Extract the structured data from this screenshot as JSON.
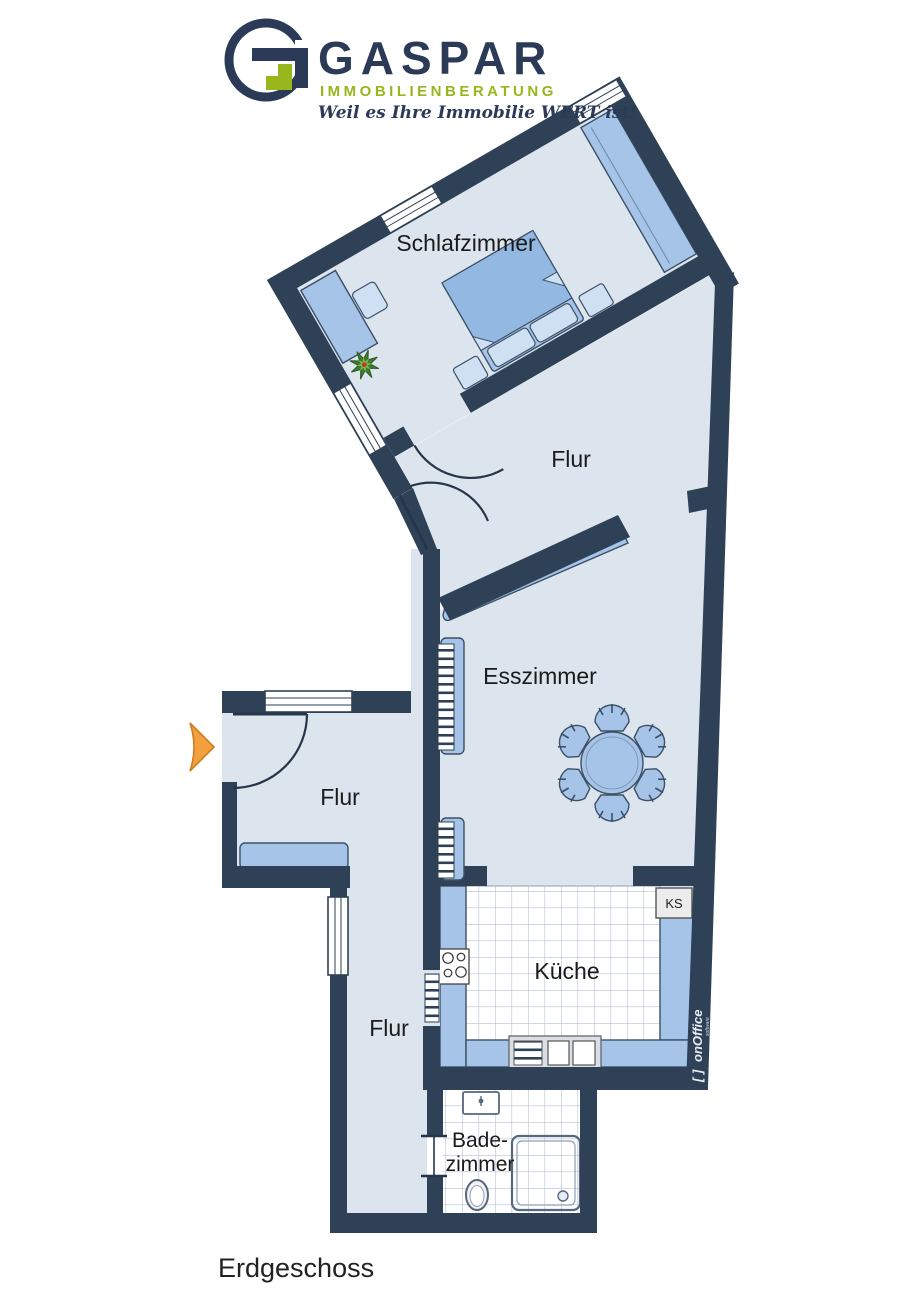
{
  "logo": {
    "brand": "GASPAR",
    "subtitle": "IMMOBILIENBERATUNG",
    "tagline": "Weil es Ihre Immobilie WERT ist!"
  },
  "plan": {
    "floor_label": "Erdgeschoss",
    "rooms": [
      {
        "id": "schlafzimmer",
        "label": "Schlafzimmer"
      },
      {
        "id": "flur-oben",
        "label": "Flur"
      },
      {
        "id": "esszimmer",
        "label": "Esszimmer"
      },
      {
        "id": "flur-eingang",
        "label": "Flur"
      },
      {
        "id": "kueche",
        "label": "Küche"
      },
      {
        "id": "flur-unten",
        "label": "Flur"
      },
      {
        "id": "badezimmer",
        "label_line1": "Bade-",
        "label_line2": "zimmer"
      }
    ],
    "appliances": {
      "fridge": "KS"
    }
  },
  "watermark": {
    "brackets": "[ ]",
    "vendor": "onOffice",
    "sub": "software"
  },
  "colors": {
    "wall": "#2e4156",
    "floor": "#dce4ee",
    "furniture": "#a5c4e7",
    "accent_green": "#97b71c",
    "brand_navy": "#2b3a57",
    "entrance_arrow": "#f2a13e",
    "tile_grid": "#b7c2d4"
  }
}
